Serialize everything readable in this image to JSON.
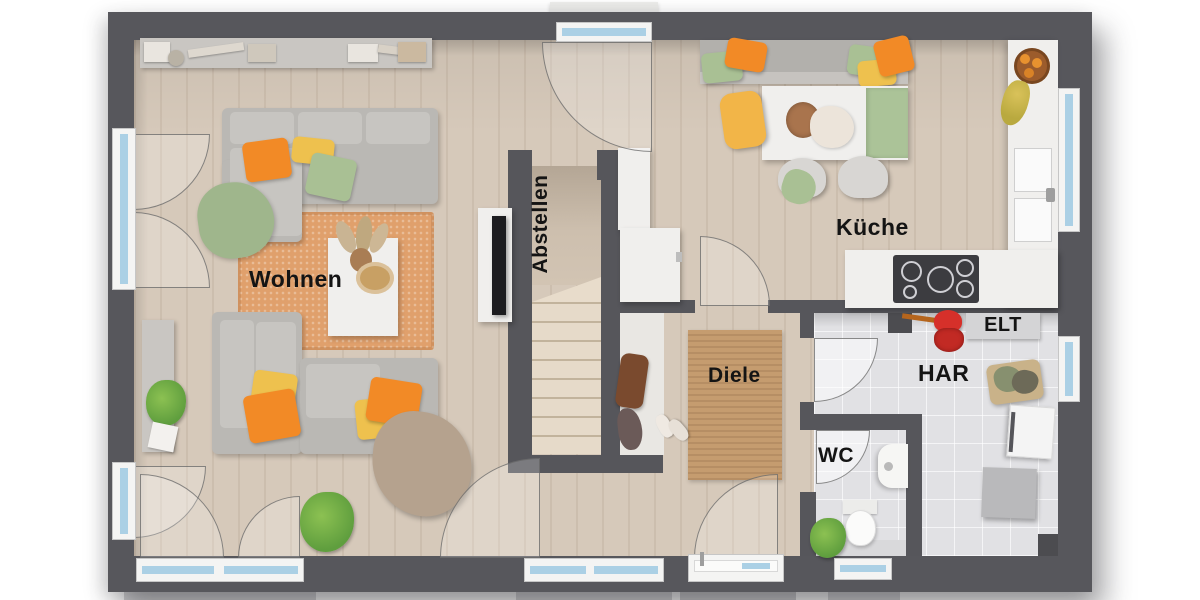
{
  "labels": {
    "wohnen": "Wohnen",
    "abstellen": "Abstellen",
    "kueche": "Küche",
    "diele": "Diele",
    "wc": "WC",
    "har": "HAR",
    "elt": "ELT"
  },
  "colors": {
    "wall": "#57575c",
    "floor_wood": "#d6c9ba",
    "floor_tile": "#e1e1e4",
    "rug_living": "#e0a06c",
    "rug_hall": "#c59c6f",
    "pillow_orange": "#f28a26",
    "pillow_yellow": "#eec14e",
    "pillow_green": "#a9c094",
    "window_glass": "#abd0e5",
    "utility_red": "#d6302a"
  }
}
